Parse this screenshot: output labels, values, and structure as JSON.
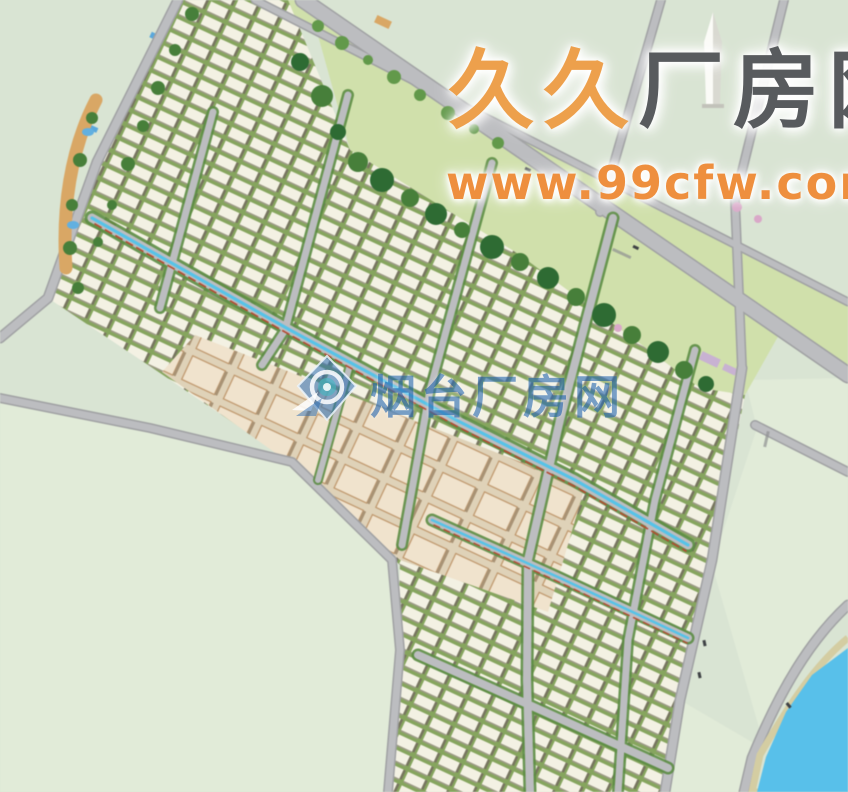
{
  "watermark": {
    "brand_orange": "久久",
    "brand_gray": "厂房网",
    "url": "www.99cfw.com",
    "center_site_name": "烟台厂房网"
  },
  "colors": {
    "land": "#d9e4d3",
    "parcel": "#e1ebd8",
    "road": "#bcbdc0",
    "roadEdge": "#a0a1a3",
    "greenFlank": "#5c8d44",
    "verge": "#d0e0ab",
    "treeDark": "#2e6b33",
    "treeMid": "#477f3a",
    "treeLight": "#62994a",
    "blossomPink": "#d9a8c8",
    "bldg": "#f3f1e3",
    "bldgShadow": "#77755f",
    "rowGap": "#86a55e",
    "beige": "#f0e3cd",
    "beigeBg": "#dfd2b8",
    "beigeEdge": "#bd9468",
    "lavender": "#c8b2d2",
    "blueRoof": "#5aa8dc",
    "redRoof": "#b0503a",
    "canal": "#56c3e8",
    "canalAccent": "#b44a32",
    "river": "#58c0ea",
    "bank": "#d4cda2",
    "pond": "#62b0e0",
    "landscape": "#d9a765",
    "car": "#3f4245",
    "monument": "#fbfbf7",
    "brandOrange": "#eda04c",
    "brandGray": "#585b5e",
    "urlOrange": "#ee8f3e",
    "centerBlue": "#2a6bb4"
  }
}
